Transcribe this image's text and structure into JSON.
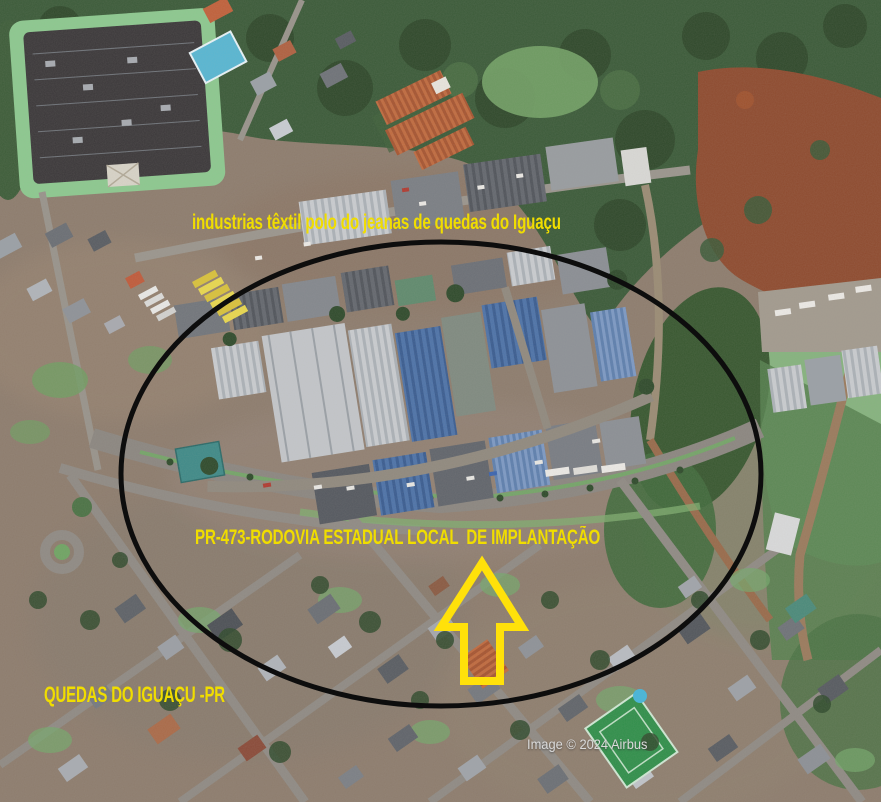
{
  "map": {
    "kind": "satellite-aerial-imagery",
    "credit": "Image © 2024 Airbus"
  },
  "annotations": {
    "industrial_pole_label": "industrias têxtil polo do jeanas de quedas do Iguaçu",
    "road_label": "PR-473-RODOVIA ESTADUAL LOCAL  DE IMPLANTAÇÃO",
    "city_label": "QUEDAS DO IGUAÇU -PR",
    "highlight_shape": "ellipse-outline",
    "arrow_direction": "up"
  },
  "colors": {
    "annotation_yellow": "#f0dd00",
    "arrow_yellow": "#ffe10a",
    "ellipse_stroke": "#0d0d0d",
    "watermark_gray": "#dadada",
    "forest_green": "#3a5a38",
    "field_green": "#85b37e",
    "dirt_red": "#8e4a2e",
    "urban_base": "#8d7c6d",
    "factory_blue_roof": "#4c72a8"
  }
}
